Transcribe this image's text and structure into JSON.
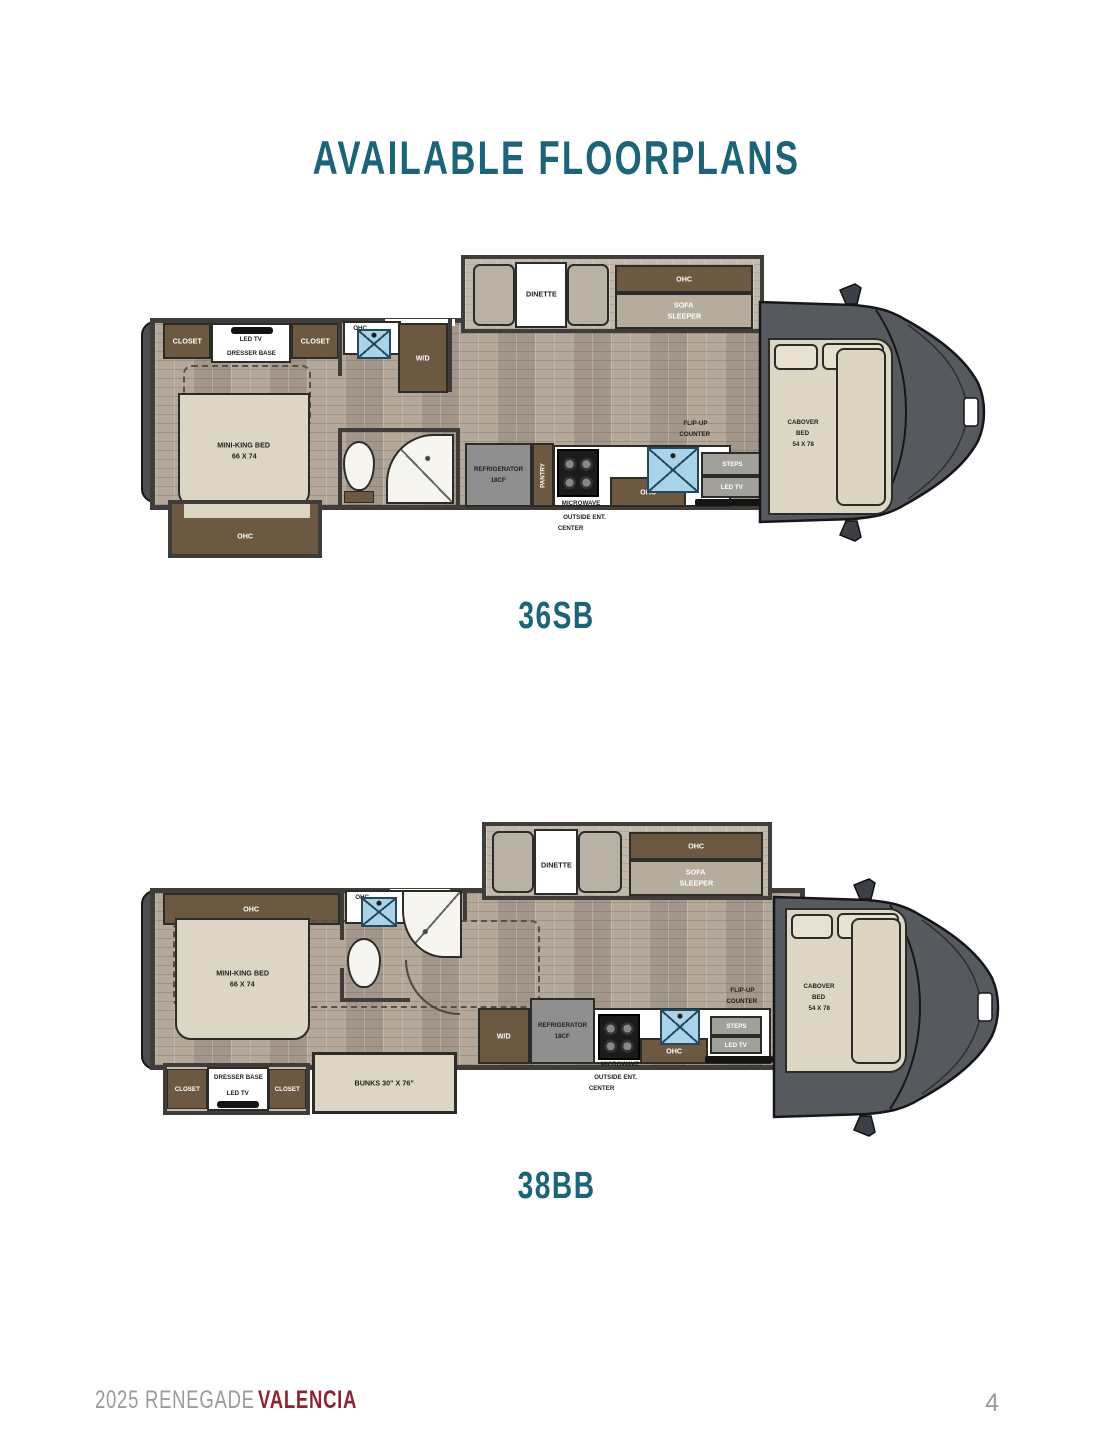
{
  "title": "AVAILABLE FLOORPLANS",
  "footer": {
    "series": "2025 RENEGADE",
    "model": "VALENCIA",
    "page": "4"
  },
  "colors": {
    "accent_teal": "#1d6478",
    "brand_maroon": "#8e2433",
    "cabinet_brown": "#6d5941",
    "cab_gray": "#565a5f",
    "sink_blue": "#a9d3e8"
  },
  "fp1": {
    "name": "36SB",
    "closet_left": "CLOSET",
    "led_tv": "LED TV",
    "dresser_base": "DRESSER BASE",
    "closet_right": "CLOSET",
    "bed_line1": "MINI-KING BED",
    "bed_line2": "66 X 74",
    "ohc_bed": "OHC",
    "ohc_bath": "OHC",
    "wd": "W/D",
    "dinette": "DINETTE",
    "ohc_sofa": "OHC",
    "sofa_line1": "SOFA",
    "sofa_line2": "SLEEPER",
    "fridge_line1": "REFRIGERATOR",
    "fridge_line2": "18CF",
    "pantry": "PANTRY",
    "microwave": "MICROWAVE",
    "ohc_kitchen": "OHC",
    "flip_line1": "FLIP-UP",
    "flip_line2": "COUNTER",
    "steps": "STEPS",
    "led_tv_entry": "LED TV",
    "outside_line1": "OUTSIDE ENT.",
    "outside_line2": "CENTER",
    "cab_line1": "CABOVER",
    "cab_line2": "BED",
    "cab_line3": "54 X 78"
  },
  "fp2": {
    "name": "38BB",
    "ohc_bedroom": "OHC",
    "bed_line1": "MINI-KING BED",
    "bed_line2": "66 X 74",
    "ohc_bath": "OHC",
    "dinette": "DINETTE",
    "ohc_sofa": "OHC",
    "sofa_line1": "SOFA",
    "sofa_line2": "SLEEPER",
    "wd": "W/D",
    "fridge_line1": "REFRIGERATOR",
    "fridge_line2": "18CF",
    "microwave": "MICROWAVE",
    "ohc_kitchen": "OHC",
    "flip_line1": "FLIP-UP",
    "flip_line2": "COUNTER",
    "steps": "STEPS",
    "led_tv_entry": "LED TV",
    "outside_line1": "OUTSIDE ENT.",
    "outside_line2": "CENTER",
    "cab_line1": "CABOVER",
    "cab_line2": "BED",
    "cab_line3": "54 X 78",
    "closet_left": "CLOSET",
    "dresser_base": "DRESSER BASE",
    "led_tv": "LED TV",
    "closet_right": "CLOSET",
    "bunks": "BUNKS 30\" X 76\""
  }
}
